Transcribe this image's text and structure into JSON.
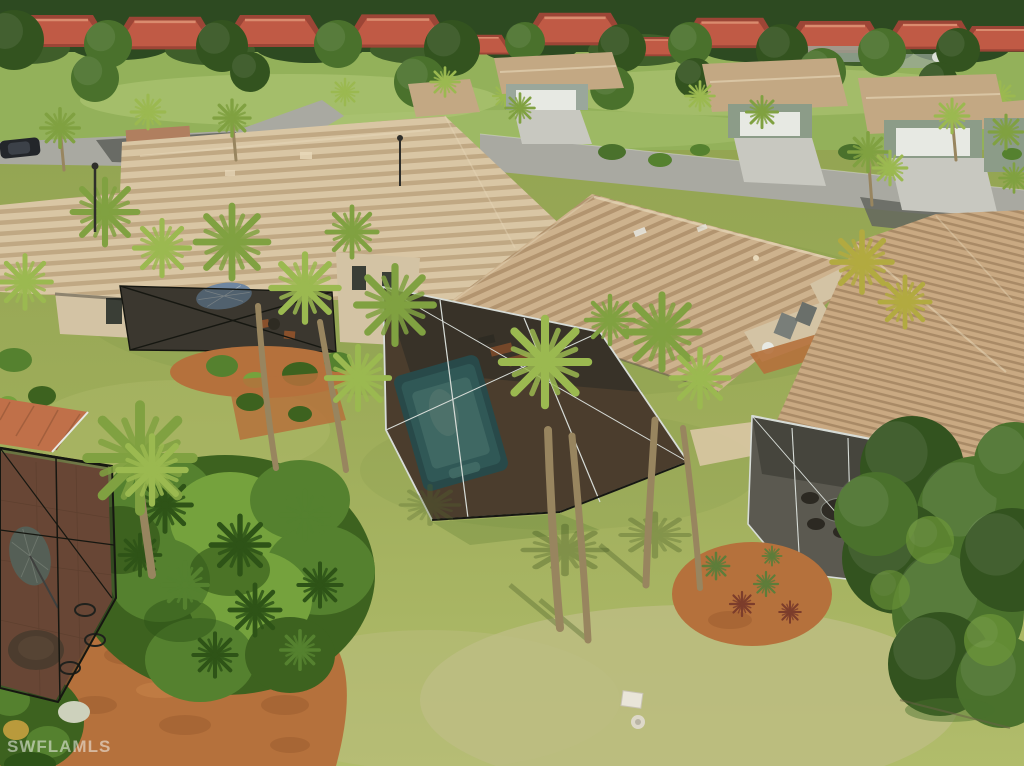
{
  "watermark": {
    "text": "SWFLAMLS"
  },
  "palette": {
    "forest": "#2d4a21",
    "forestLight": "#3f5e2a",
    "treeDark": "#33531f",
    "treeMid": "#4a712c",
    "treeLight": "#6d9738",
    "golf": "#93b15a",
    "golfLight": "#b3c878",
    "roofRed": "#c05a45",
    "roofRedDark": "#9c4536",
    "roofRedLight": "#da8b6e",
    "roofTan": "#cdb28d",
    "roofStripe": "#b2946f",
    "roofTanBase": "#d9c6a4",
    "roofStripeB": "#c0a883",
    "roofRight": "#c9a982",
    "roofStripeR": "#a98a66",
    "roofMid": "#c3a883",
    "roofTanLight": "#e8d9ba",
    "roofOrange": "#c07049",
    "wallTan": "#d3c3a4",
    "wallGray": "#9aa79b",
    "wallGreen": "#8c9c88",
    "doorWhite": "#e7e9e3",
    "windowDark": "#3a3e36",
    "driveway": "#c8c8c0",
    "road": "#a9a9a1",
    "asphalt": "#64665f",
    "paver": "#b07f5f",
    "paverFloor": "#9c6045",
    "concrete": "#8b8679",
    "lawn": "#9dac59",
    "lawnTop": "#90a250",
    "lawnDark": "#7e9646",
    "lawnLight": "#b1bc6b",
    "lawnDry": "#bfbe85",
    "mulch": "#b5713c",
    "mulchDark": "#8f5429",
    "mulchLight": "#d08e50",
    "shrub": "#55812f",
    "shrubDark": "#3d621f",
    "shrubLight": "#75a23d",
    "shrubDeep": "#2e5317",
    "palmFrond": "#80a141",
    "palmFrondLight": "#9bb950",
    "palmGold": "#b2aa40",
    "trunk": "#98855f",
    "branch": "#6b6048",
    "mesh": "#3a3d36",
    "meshDark": "#22241e",
    "cageFrame": "#d7dcd7",
    "frameDark": "#161711",
    "pool": "#3f8d8f",
    "poolLight": "#63b2ad",
    "poolDeep": "#2e6f74",
    "poolGlint": "#8ccbc2",
    "deck": "#74573d",
    "shade": "#3a352c",
    "umbrella": "#6f86a0",
    "umbrellaLeft": "#7b8b7e",
    "furnitureOrange": "#c96b35",
    "furnitureDark": "#362f26",
    "acUnit": "#797e79",
    "acUnit2": "#6a6f6a",
    "white": "#e9e5d9",
    "goldShrub": "#b99a3c",
    "whiteShrub": "#cdd1bc",
    "agaveRed": "#7c3d2b",
    "agaveGreen": "#5e7d3a",
    "shadowGreen": "#55682e",
    "watermark": "#f2f2ee"
  }
}
